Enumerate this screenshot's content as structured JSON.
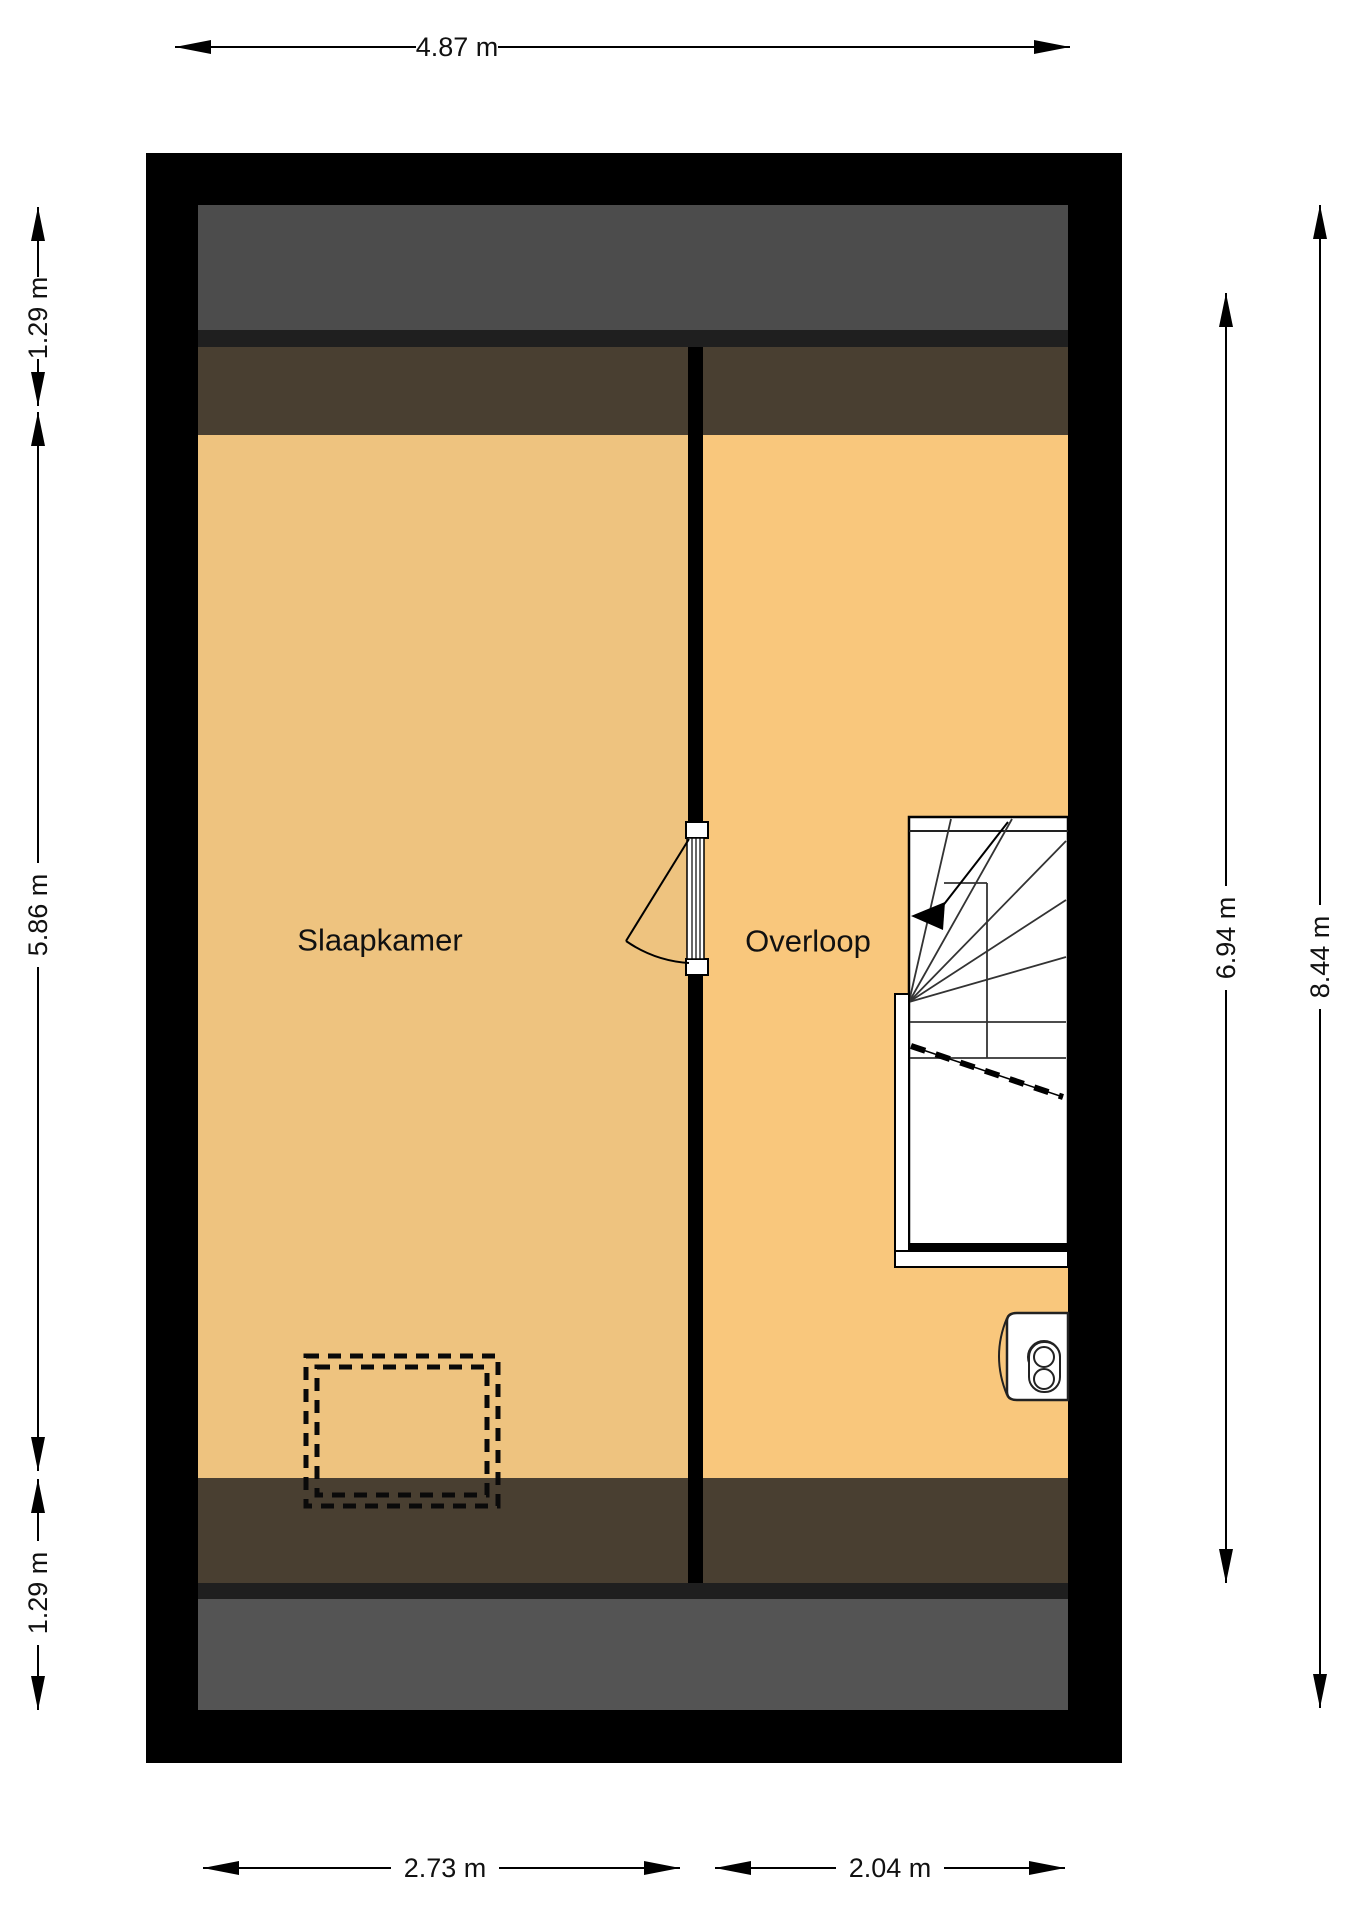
{
  "plan": {
    "title": "floor-plan-attic",
    "rooms": [
      {
        "label": "Slaapkamer"
      },
      {
        "label": "Overloop"
      }
    ]
  },
  "dimensions": {
    "top_width": "4.87 m",
    "left_top": "1.29 m",
    "left_middle": "5.86 m",
    "left_bottom": "1.29 m",
    "right_inner_height": "6.94 m",
    "right_total_height": "8.44 m",
    "bottom_left_width": "2.73 m",
    "bottom_right_width": "2.04 m"
  },
  "colors": {
    "wall": "#000000",
    "roof_gray_top": "#4c4c4c",
    "roof_gray_bottom": "#545454",
    "dark_line": "#1f1f1f",
    "roof_brown": "#493f31",
    "floor_slaapkamer": "#eec37f",
    "floor_overloop": "#f9c77c",
    "stair_fill": "#ffffff",
    "background": "#ffffff"
  }
}
